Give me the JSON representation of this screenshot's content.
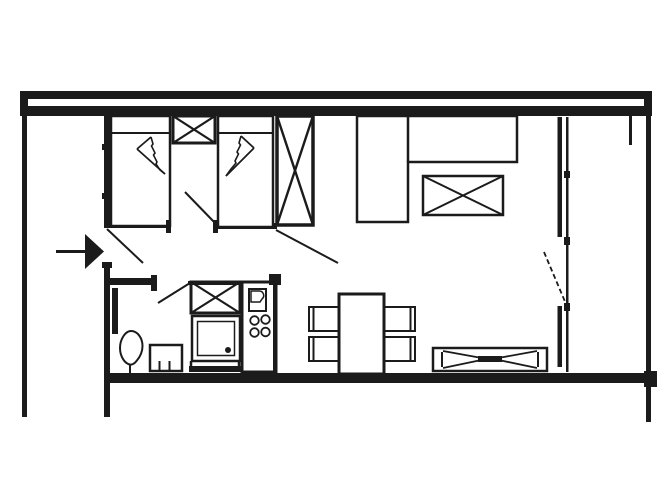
{
  "document": {
    "type": "apartment-floor-plan",
    "background_color": "#ffffff",
    "ink_color": "#1b1b1b",
    "visible_text": "none"
  },
  "elements": {
    "plan": {
      "label": "Studio apartment floor plan, top-down line drawing"
    },
    "top_wall": {
      "label": "Top exterior double wall band"
    },
    "left_wall": {
      "label": "Left exterior wall"
    },
    "right_wall": {
      "label": "Right exterior wall"
    },
    "bottom_wall": {
      "label": "Bottom exterior wall"
    },
    "bedroom_wall": {
      "label": "Interior wall with window ticks (left)"
    },
    "hall_stub_wall": {
      "label": "Short hallway partition wall"
    },
    "bedroom_bottom_wall": {
      "label": "Bedroom lower partition wall"
    },
    "entrance_arrow": {
      "label": "Entrance direction arrow"
    },
    "entrance_door": {
      "label": "Entrance door swing"
    },
    "bedroom_door": {
      "label": "Bedroom door swing"
    },
    "living_door": {
      "label": "Living room door swing"
    },
    "kitchen_door": {
      "label": "Kitchen cabinet door swing"
    },
    "balcony_door": {
      "label": "Balcony door swing (dashed)"
    },
    "bed_1": {
      "label": "Single bed with folded duvet symbol"
    },
    "bed_2": {
      "label": "Single bed with folded duvet symbol"
    },
    "nightstand": {
      "label": "Nightstand with X"
    },
    "wardrobe": {
      "label": "Wardrobe with X"
    },
    "sofa": {
      "label": "L-shaped corner sofa"
    },
    "coffee_table": {
      "label": "Coffee table with X"
    },
    "dining_table": {
      "label": "Dining table"
    },
    "chair_1": {
      "label": "Dining chair"
    },
    "chair_2": {
      "label": "Dining chair"
    },
    "chair_3": {
      "label": "Dining chair"
    },
    "chair_4": {
      "label": "Dining chair"
    },
    "sideboard": {
      "label": "Low sideboard / radiator with bowtie pattern"
    },
    "kitchen_cabinet": {
      "label": "Kitchen cabinet with X"
    },
    "kitchen_appliance": {
      "label": "Appliance with drain dot"
    },
    "kitchen_plinth": {
      "label": "Kitchen plinth base"
    },
    "kitchen_unit": {
      "label": "Tall kitchen unit"
    },
    "kitchen_sink": {
      "label": "Kitchen sink with basin"
    },
    "cooktop": {
      "label": "Four-burner cooktop"
    },
    "radiator": {
      "label": "Wall radiator panel"
    },
    "plant": {
      "label": "Potted plant"
    },
    "stool": {
      "label": "Stool / small seat"
    },
    "window_front": {
      "label": "Glazed window front with mullions"
    },
    "wall_stub": {
      "label": "Short wall stub near right corner"
    }
  }
}
